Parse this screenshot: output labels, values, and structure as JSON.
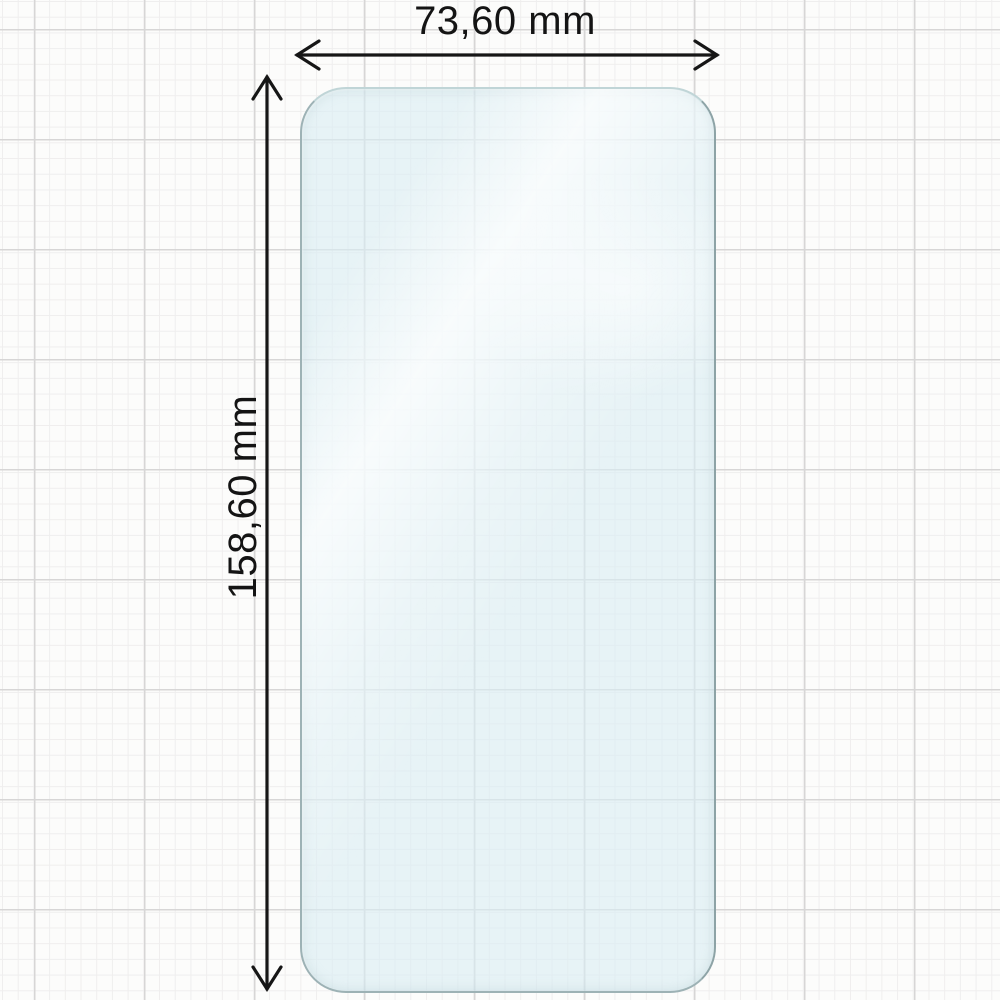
{
  "diagram": {
    "type": "product-dimension-diagram",
    "subject": "phone screen protector on graph paper",
    "width_label": "73,60 mm",
    "height_label": "158,60 mm"
  },
  "colors": {
    "paper": "#fcfcfb",
    "grid_minor": "#efeeee",
    "grid_major": "#d7d6d6",
    "protector_fill": "rgba(216,237,244,0.60)",
    "protector_edge_light": "#c0d5d7",
    "protector_edge_mid": "#9db2b5",
    "protector_edge_dark": "#8da3a6",
    "arrow": "#161616",
    "label_text": "#141414"
  }
}
